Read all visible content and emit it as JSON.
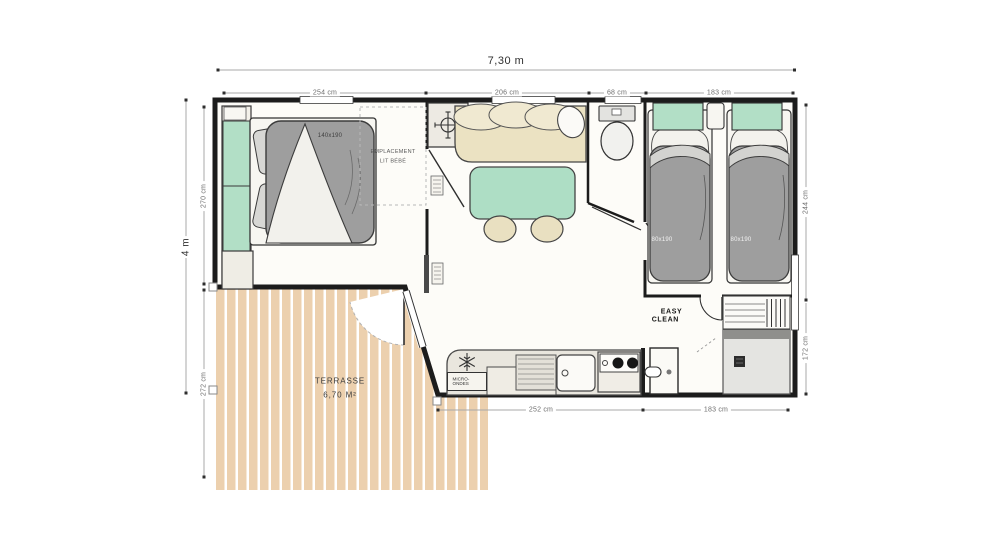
{
  "dimensions": {
    "top_total": "7,30 m",
    "top_segments": [
      "254 cm",
      "206 cm",
      "68 cm",
      "183 cm"
    ],
    "left_total": "4 m",
    "left_segments": [
      "270 cm",
      "272 cm"
    ],
    "right_segments": [
      "244 cm",
      "172 cm"
    ],
    "bottom_segments": [
      "252 cm",
      "183 cm"
    ]
  },
  "labels": {
    "double_bed_size": "140x190",
    "baby_space": [
      "EMPLACEMENT",
      "LIT BÉBÉ"
    ],
    "single_bed_sizes": [
      "80x190",
      "80x190"
    ],
    "microwave": "MICRO-ONDES",
    "terrace": [
      "TERRASSE",
      "6,70 M²"
    ],
    "brand": [
      "EASY",
      "CLEAN"
    ]
  },
  "icons": {
    "water_heater": "crosshair-target-icon",
    "fridge": "snowflake-icon"
  },
  "colors": {
    "wall": "#1c1c1c",
    "mint": "#b2dfc6",
    "sofa_beige": "#ebe2c2",
    "duvet_gray": "#9e9e9e",
    "terrace_plank": "#ecd0ae",
    "counter": "#e9e6de"
  }
}
